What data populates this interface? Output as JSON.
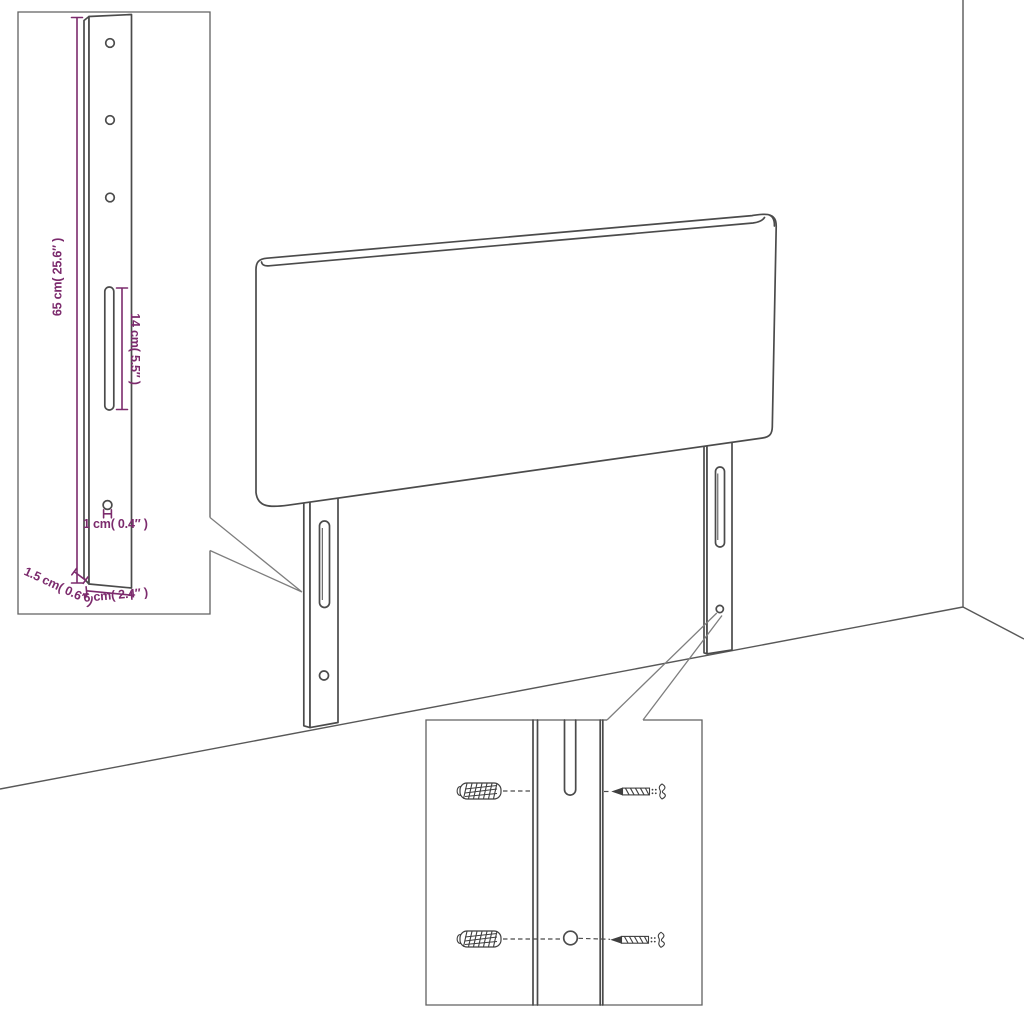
{
  "canvas": {
    "width": 1024,
    "height": 1024,
    "background": "#ffffff"
  },
  "colors": {
    "drawing_line": "#4b4b4b",
    "inset_border": "#616161",
    "leader_line": "#7e7e7e",
    "dimension_accent": "#7c2b6d"
  },
  "scene": {
    "description": "Line drawing of an upholstered headboard with two slotted mounting legs standing in a room corner",
    "parts": {
      "headboard": "headboard-panel",
      "left_leg": "mounting-leg-with-slot-and-hole",
      "right_leg": "mounting-leg-with-slot-and-hole",
      "room": "wall-floor-corner-lines"
    }
  },
  "leg_detail": {
    "labels": {
      "height": "65 cm( 25.6″ )",
      "slot_length": "14 cm( 5.5″ )",
      "hole_diameter": "1 cm( 0.4″ )",
      "thickness": "1.5 cm( 0.6″ )",
      "width": "6 cm( 2.4″ )"
    }
  },
  "mounting_detail": {
    "hardware": {
      "top_left": "wall-plug",
      "top_right": "screw",
      "bottom_left": "wall-plug",
      "bottom_right": "screw"
    },
    "features": [
      "leg-slot",
      "leg-hole"
    ]
  }
}
